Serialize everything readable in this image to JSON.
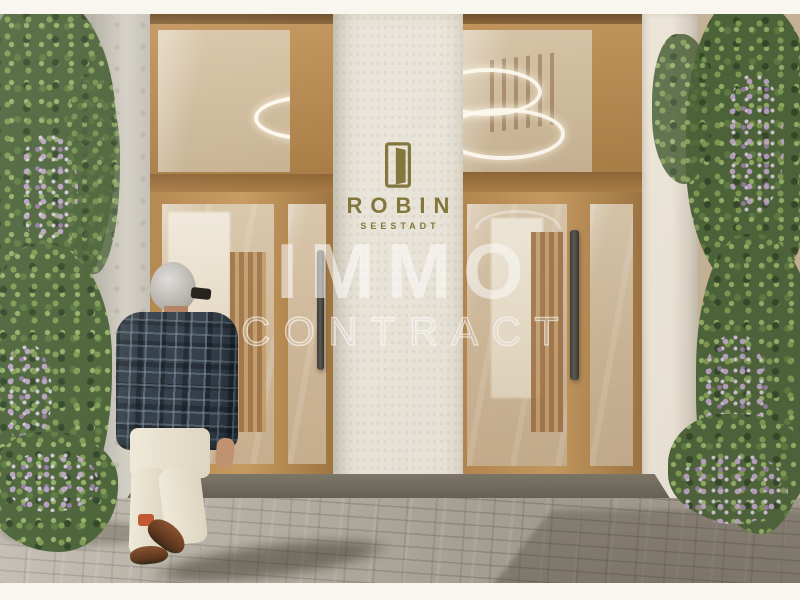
{
  "image": {
    "kind": "architectural-entrance-render",
    "letterbox_color": "#f9f6ef"
  },
  "logo": {
    "icon": "door-icon",
    "name": "ROBIN",
    "subtitle": "SEESTADT",
    "color": "#83773d"
  },
  "watermark": {
    "line1": "IMMO",
    "line2": "CONTRACT",
    "color": "#ffffff"
  },
  "palette": {
    "wood_frame": "#b5854d",
    "pillar": "#eae5da",
    "pavement": "#b2ac9f",
    "foliage": "#4a6238",
    "flowers": "#b897c8",
    "blazer_plaid": "#323d48",
    "pants": "#e7e0ce",
    "threshold": "#6f6a5e"
  },
  "scene": {
    "figure": "man-walking-toward-entrance",
    "lights": "ring-pendant-lights",
    "plants": "climbing-vines-with-purple-flowers"
  }
}
